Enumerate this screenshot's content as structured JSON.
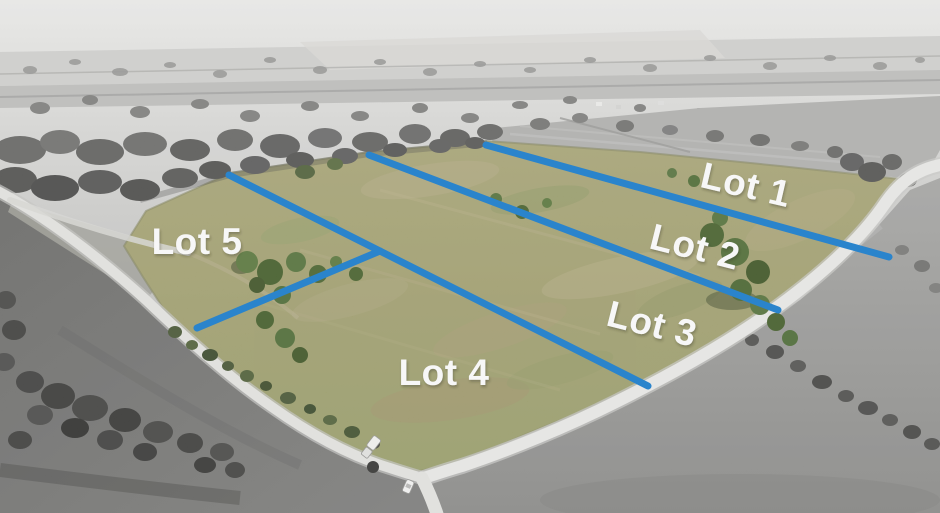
{
  "photo": {
    "kind": "aerial-drone-photograph",
    "subject": "Rural acreage subdivided into five lots; property shown in color, surrounding land desaturated",
    "annotations": "Blue lot boundary lines with white lot number labels; roads border the parcel with a T-intersection at bottom"
  },
  "lots": [
    {
      "label": "Lot 1"
    },
    {
      "label": "Lot 2"
    },
    {
      "label": "Lot 3"
    },
    {
      "label": "Lot 4"
    },
    {
      "label": "Lot 5"
    }
  ],
  "colors": {
    "boundary_line": "#1b7fd0",
    "label_text": "#ffffff"
  }
}
